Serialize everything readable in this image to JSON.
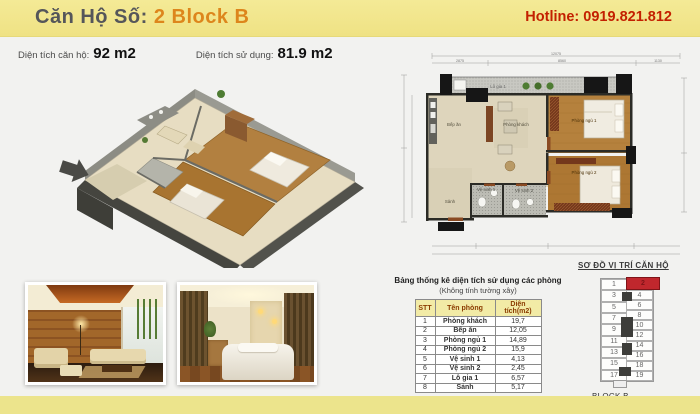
{
  "header": {
    "title_prefix": "Căn Hộ Số: ",
    "title_highlight": "2 Block B",
    "hotline": "Hotline: 0919.821.812"
  },
  "areas": {
    "apartment_label": "Diện tích căn hộ:",
    "apartment_value": "92 m2",
    "usable_label": "Diện tích sử dụng:",
    "usable_value": "81.9 m2"
  },
  "floorplan": {
    "rooms": {
      "kitchen": "Bếp ăn",
      "living": "Phòng khách",
      "bedroom1": "Phòng ngủ 1",
      "bedroom2": "Phòng ngủ 2",
      "bath1": "Vệ sinh 1",
      "bath2": "Vệ sinh 2",
      "hall": "Sảnh",
      "loggia": "Lô gia 1"
    },
    "dimensions": {
      "top_total": "12075",
      "top_left": "2875",
      "top_mid": "8560",
      "top_right": "1130"
    }
  },
  "table": {
    "title": "Bảng thống kê diện tích sử dụng các phòng",
    "subtitle": "(Không tính tường xây)",
    "headers": [
      "STT",
      "Tên phòng",
      "Diện tích(m2)"
    ],
    "rows": [
      {
        "stt": "1",
        "name": "Phòng khách",
        "area": "19,7"
      },
      {
        "stt": "2",
        "name": "Bếp ăn",
        "area": "12,05"
      },
      {
        "stt": "3",
        "name": "Phòng ngủ 1",
        "area": "14,89"
      },
      {
        "stt": "4",
        "name": "Phòng ngủ 2",
        "area": "15,9"
      },
      {
        "stt": "5",
        "name": "Vệ sinh 1",
        "area": "4,13"
      },
      {
        "stt": "6",
        "name": "Vệ sinh 2",
        "area": "2,45"
      },
      {
        "stt": "7",
        "name": "Lô gia 1",
        "area": "6,57"
      },
      {
        "stt": "8",
        "name": "Sảnh",
        "area": "5,17"
      }
    ]
  },
  "location": {
    "title": "SƠ ĐỒ VỊ TRÍ CĂN HỘ",
    "block_label": "BLOCK B",
    "highlighted_unit": "2",
    "left_units": [
      "1",
      "3",
      "5",
      "7",
      "9",
      "11",
      "13",
      "15",
      "17"
    ],
    "right_units": [
      "2",
      "4",
      "6",
      "8",
      "10",
      "12",
      "14",
      "16",
      "18",
      "19"
    ]
  },
  "colors": {
    "header_yellow": "#f2e891",
    "accent_orange": "#dd861c",
    "hotline_red": "#c32000",
    "highlight_unit_red": "#c0272d",
    "wood_floor": "#b5813d",
    "tile_floor": "#ded5bc"
  }
}
